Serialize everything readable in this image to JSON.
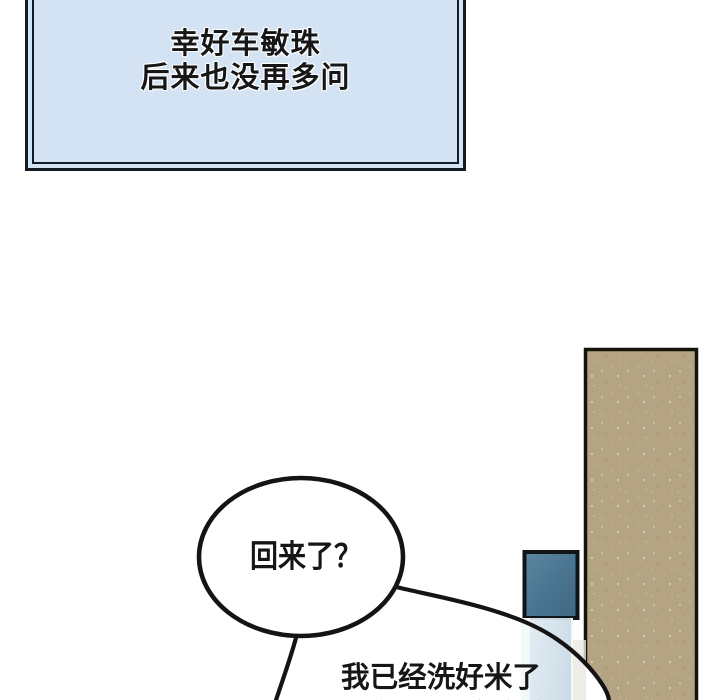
{
  "comic": {
    "narration": {
      "line1": "幸好车敏珠",
      "line2": "后来也没再多问",
      "fill_color": "#d4e3f4",
      "border_color": "#141b25"
    },
    "bubble1": {
      "text": "回来了？"
    },
    "bubble2": {
      "text": "我已经洗好米了",
      "text_partial": "米饭马上就能好"
    },
    "scene": {
      "paper_color": "#ffffff",
      "ink_color": "#141414",
      "door_panel_color": "#b5a484",
      "window_color": "#4a7592",
      "glass_color": "#d8e5ee"
    }
  }
}
